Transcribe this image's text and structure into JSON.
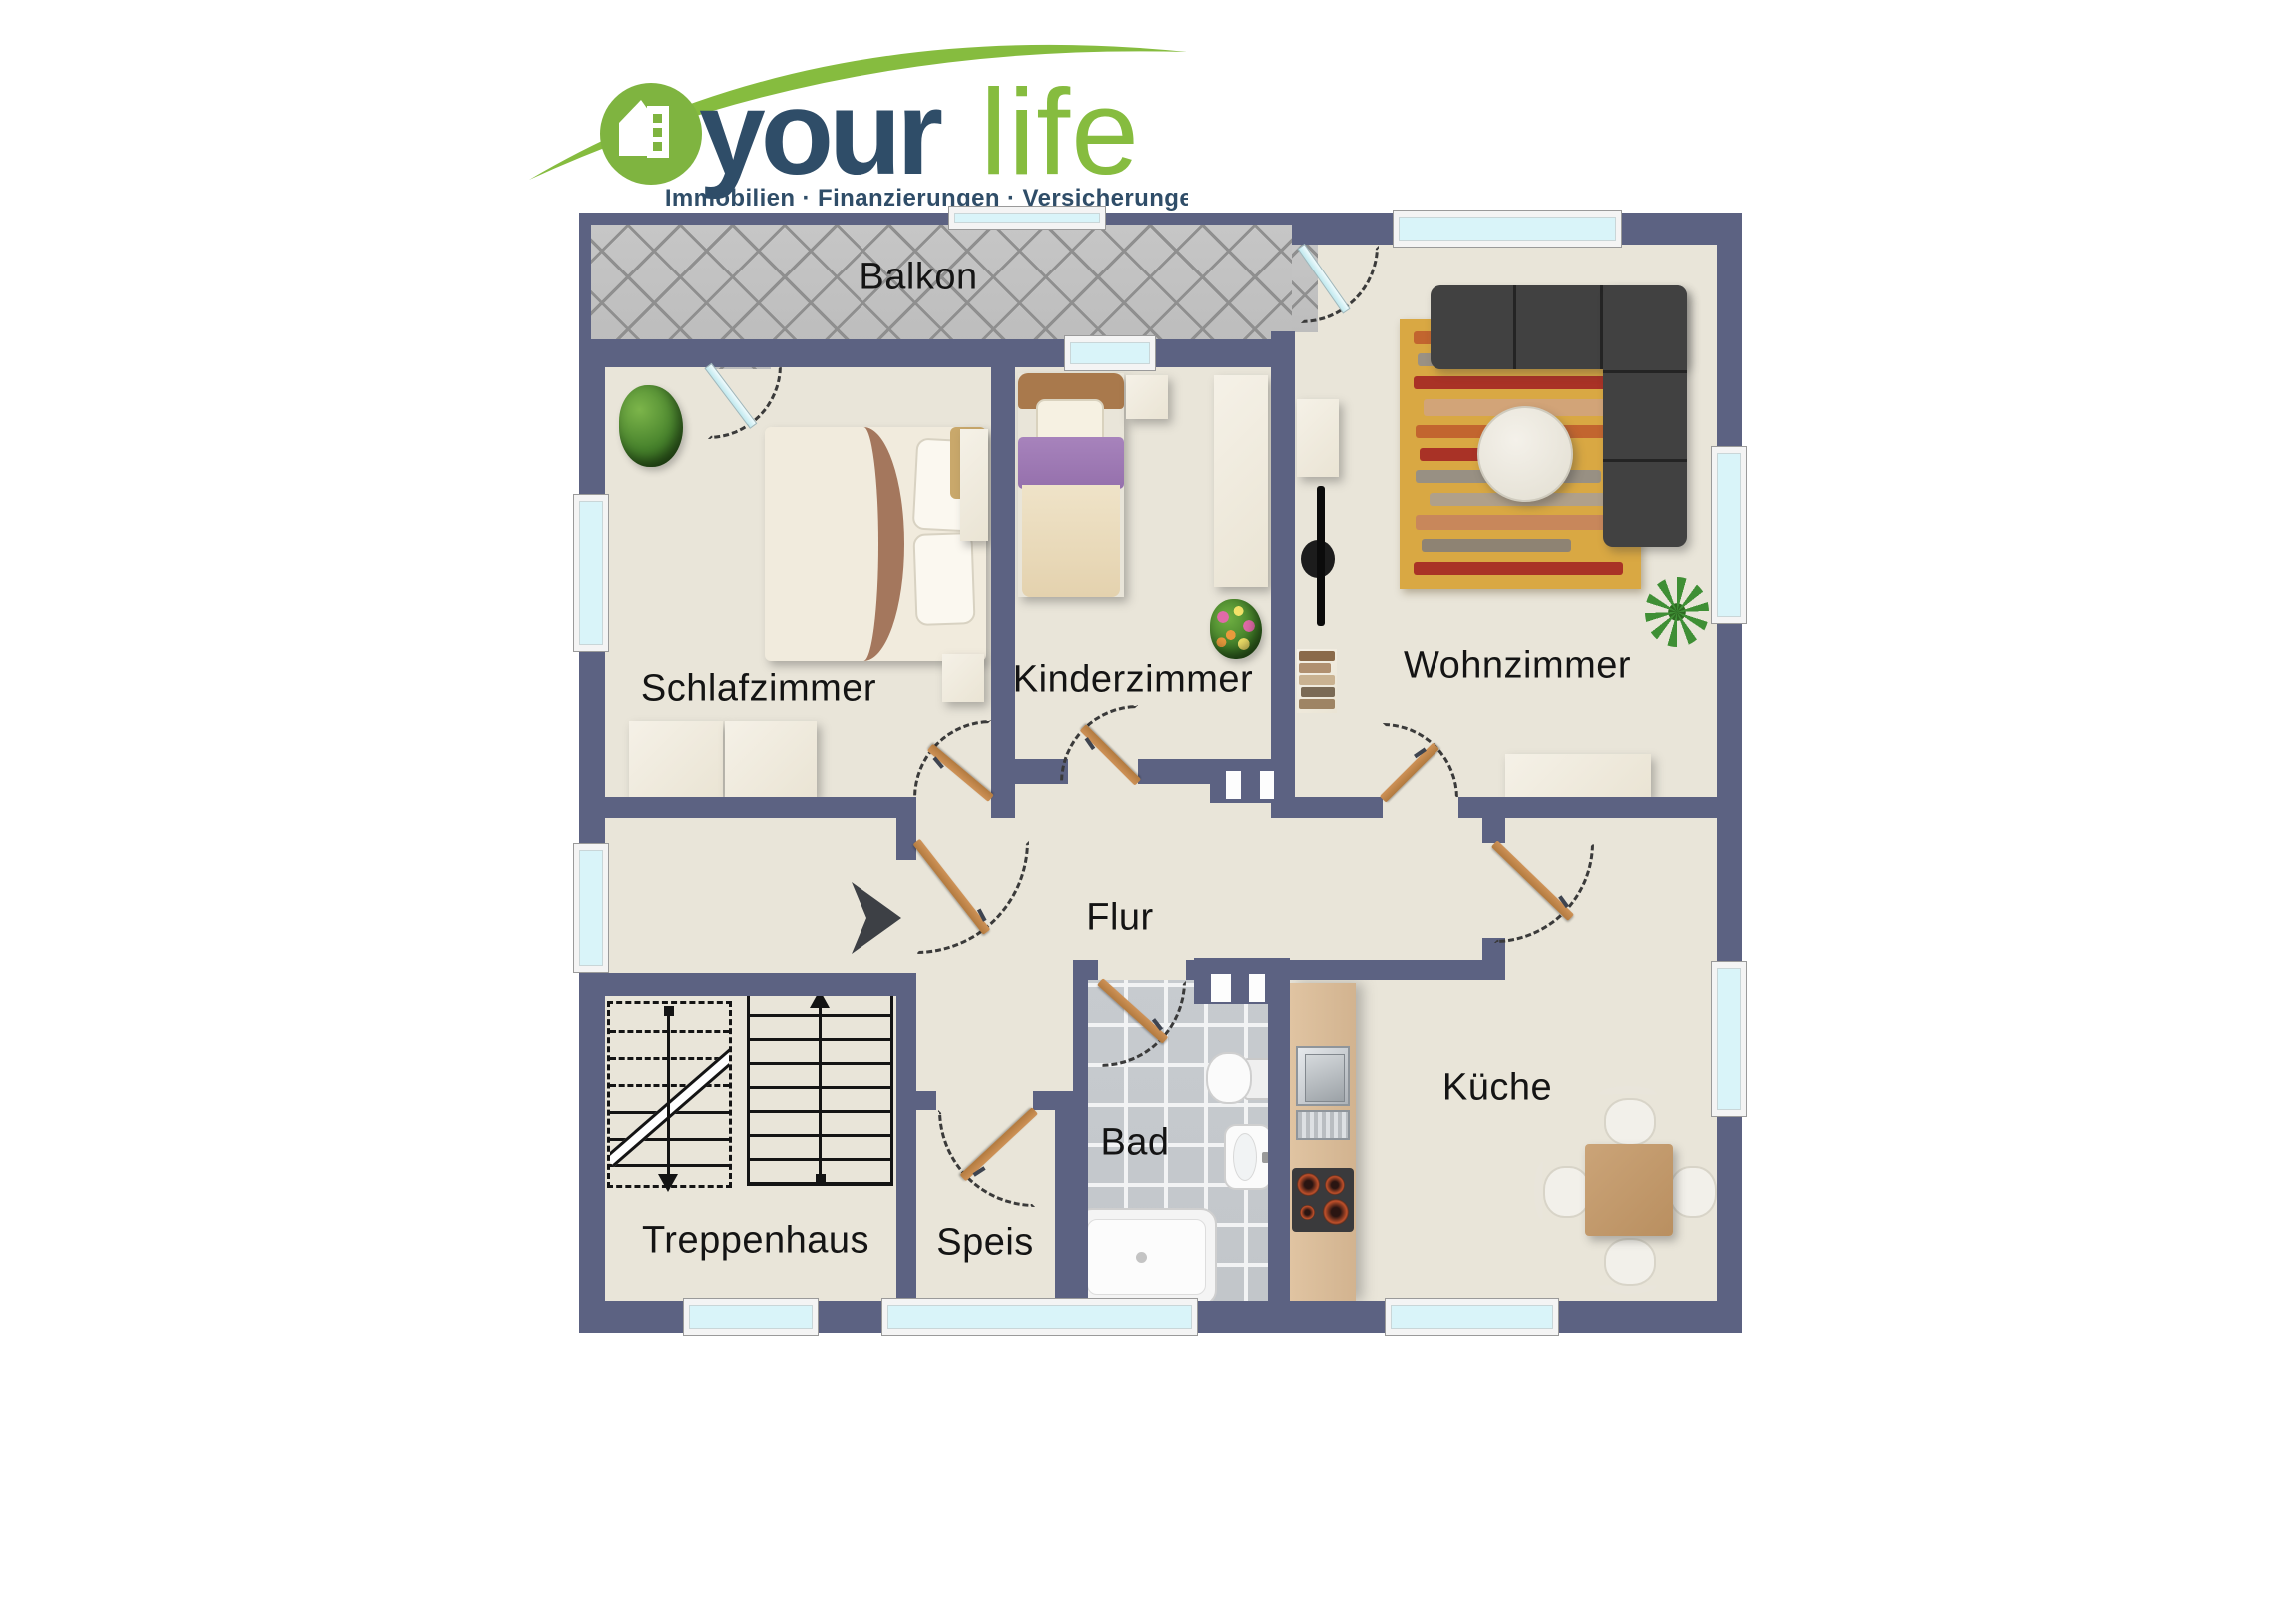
{
  "logo": {
    "brand_first": "your",
    "brand_second": "life",
    "tagline": "Immobilien · Finanzierungen · Versicherungen",
    "icon": "house-in-circle-icon",
    "colors": {
      "green": "#86BC3F",
      "navy": "#2F4D68"
    }
  },
  "floorplan": {
    "rooms": [
      {
        "id": "balkon",
        "label": "Balkon"
      },
      {
        "id": "schlafzimmer",
        "label": "Schlafzimmer"
      },
      {
        "id": "kinderzimmer",
        "label": "Kinderzimmer"
      },
      {
        "id": "wohnzimmer",
        "label": "Wohnzimmer"
      },
      {
        "id": "flur",
        "label": "Flur"
      },
      {
        "id": "treppenhaus",
        "label": "Treppenhaus"
      },
      {
        "id": "speis",
        "label": "Speis"
      },
      {
        "id": "bad",
        "label": "Bad"
      },
      {
        "id": "kueche",
        "label": "Küche"
      }
    ],
    "colors": {
      "wall": "#5C6282",
      "floor": "#E9E5D9",
      "balcony_tile": "#C3C3C3",
      "bath_tile": "#C6CACC",
      "window_glass": "#D9F4F9",
      "door_wood": "#BF8448"
    },
    "icons": [
      "entrance-arrow-icon",
      "double-bed",
      "single-bed",
      "corner-sofa",
      "striped-rug",
      "coffee-table",
      "tv",
      "wall-shelf",
      "book-stack",
      "sideboard",
      "wardrobe",
      "dresser",
      "nightstand",
      "dining-table",
      "chair",
      "kitchen-counter",
      "kitchen-sink",
      "dish-drainer",
      "stove",
      "toilet",
      "washbasin",
      "bathtub",
      "stairs-up-flight",
      "stairs-down-flight",
      "plant"
    ]
  }
}
